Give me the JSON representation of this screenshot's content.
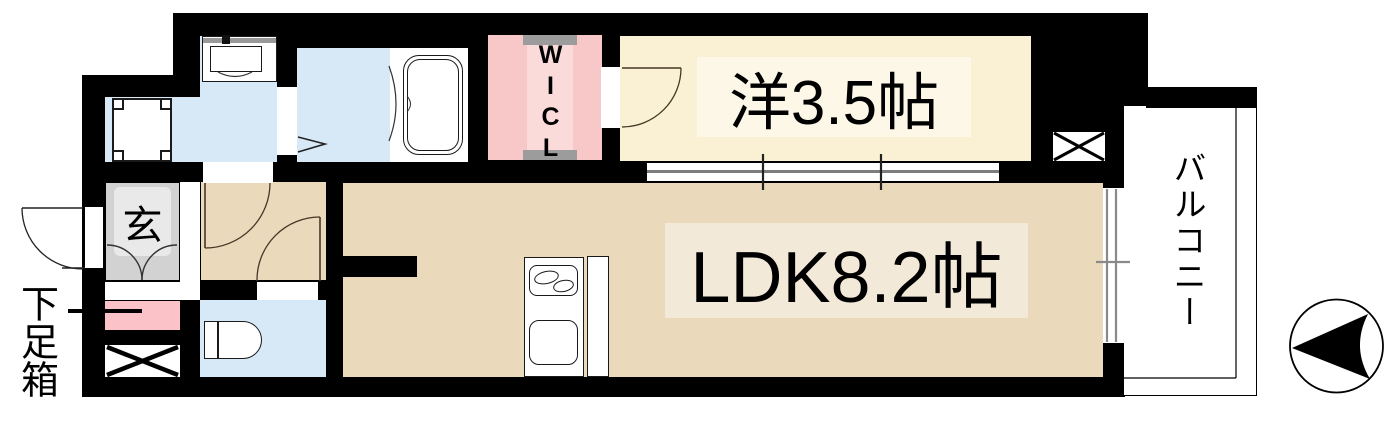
{
  "plan": {
    "type": "apartment-floor-plan",
    "rooms": {
      "western_room": {
        "label": "洋3.5帖"
      },
      "ldk": {
        "label": "LDK8.2帖"
      },
      "walk_in_closet": {
        "label": "WICL"
      },
      "entrance": {
        "label": "玄"
      },
      "shoe_box": {
        "label": "下足箱"
      },
      "balcony": {
        "label": "バルコニー"
      }
    },
    "colors": {
      "wall": "#000000",
      "western_room_fill": "#FAF0D3",
      "western_room_label_box": "#FCF7E7",
      "ldk_fill": "#EBD9BC",
      "ldk_label_box": "#F2E9D9",
      "water_area_blue": "#D7E8F7",
      "closet_pink": "#F8C8C8",
      "closet_pink_light": "#FBDADA",
      "shoe_box_pink": "#FBC3C8",
      "entrance_gray": "#D2D2D2",
      "entrance_label_box": "#E9E9E9",
      "hanger_cap_gray": "#9C9C9C",
      "balcony_fill": "#FFFFFF"
    },
    "icons": {
      "compass": "north-arrow-icon",
      "pipe_space": "pipe-space-x-icon",
      "bath": "bathtub-icon",
      "toilet": "toilet-icon",
      "kitchen": "kitchen-counter-icon",
      "washer": "washer-pan-icon",
      "vanity": "vanity-basin-icon"
    }
  }
}
